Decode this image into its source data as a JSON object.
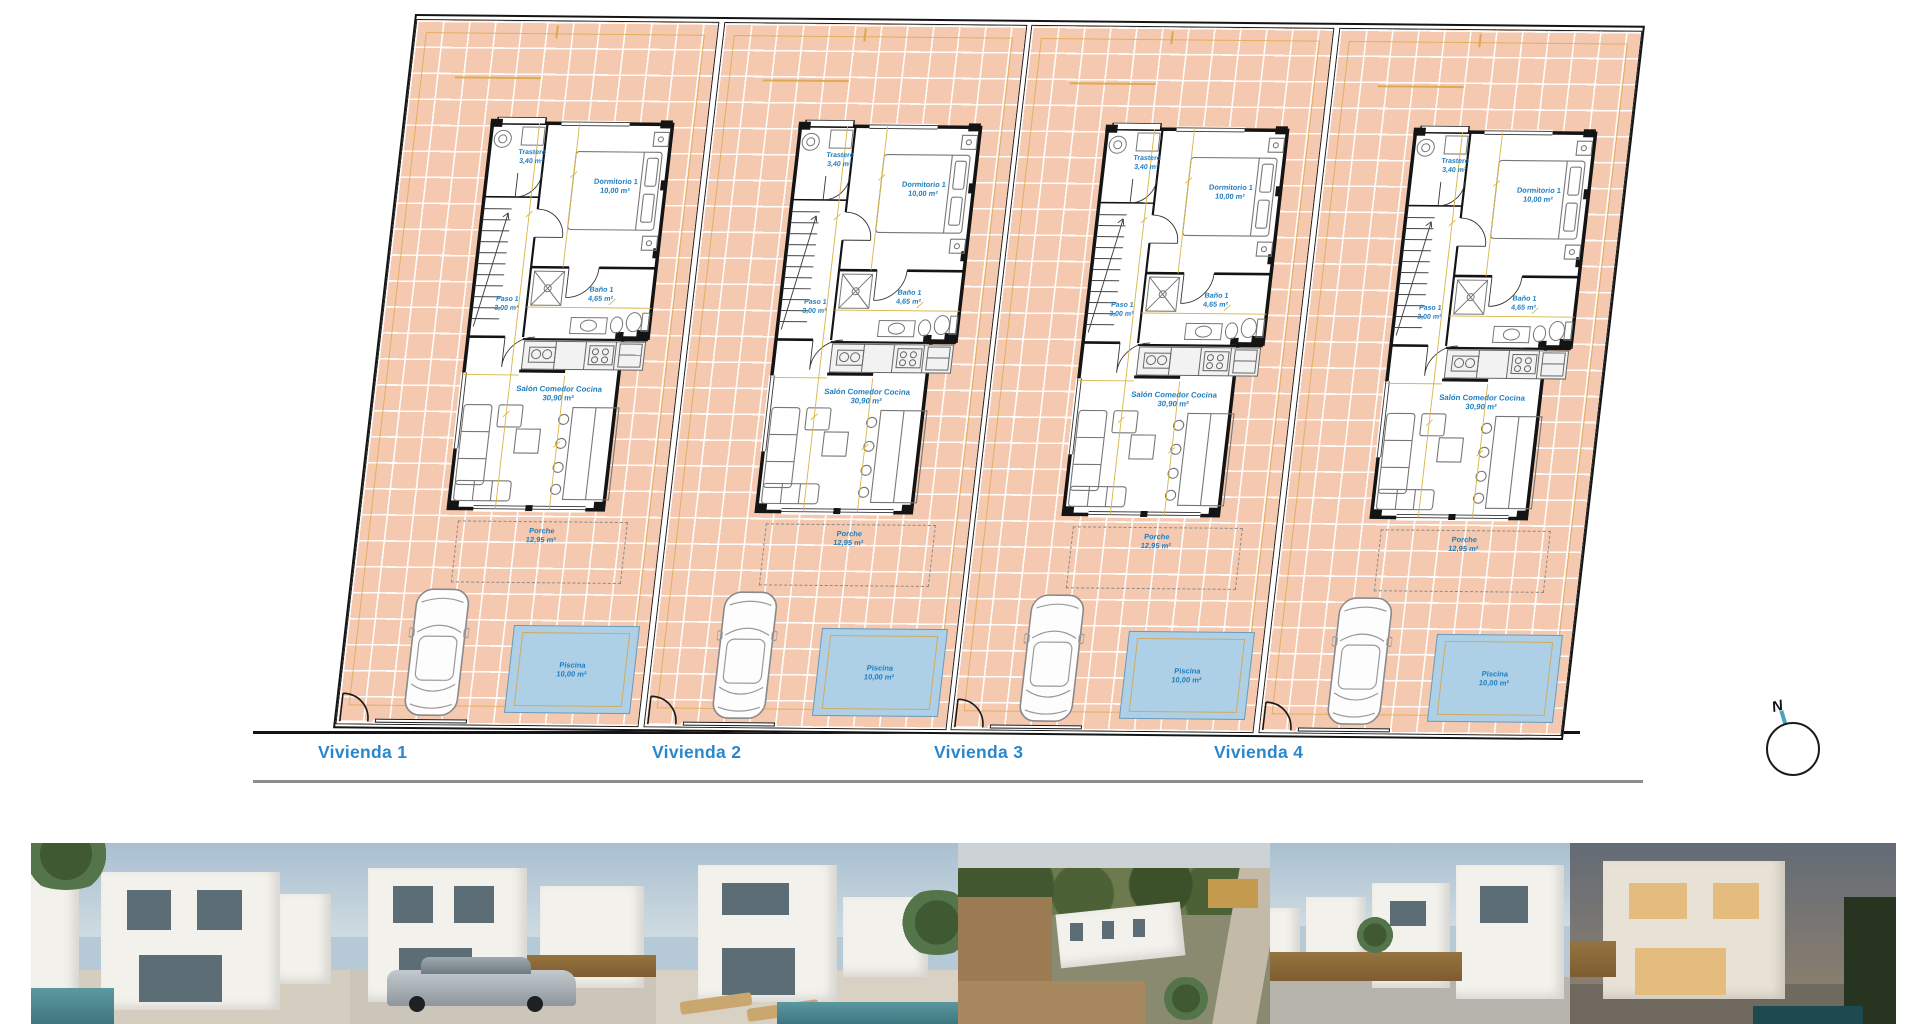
{
  "site": {
    "viviendas": [
      {
        "label": "Vivienda 1"
      },
      {
        "label": "Vivienda 2"
      },
      {
        "label": "Vivienda 3"
      },
      {
        "label": "Vivienda 4"
      }
    ],
    "compass_label": "N"
  },
  "plan": {
    "rooms": {
      "trastero": {
        "name": "Trastero",
        "area": "3,40 m²"
      },
      "dormitorio": {
        "name": "Dormitorio 1",
        "area": "10,00 m²"
      },
      "paso": {
        "name": "Paso 1",
        "area": "3,00 m²"
      },
      "bano": {
        "name": "Baño 1",
        "area": "4,65 m²"
      },
      "salon": {
        "name": "Salón Comedor Cocina",
        "area": "30,90 m²"
      },
      "porche": {
        "name": "Porche",
        "area": "12,95 m²"
      },
      "piscina": {
        "name": "Piscina",
        "area": "10,00 m²"
      }
    }
  },
  "colors": {
    "accent_blue": "#2a87cc",
    "label_blue": "#1e7dc0",
    "tile_salmon": "#f5c9af",
    "pool_blue": "#aed0e6",
    "dimension_yellow": "#d9b544",
    "wall_black": "#141414"
  },
  "photos": [
    {
      "name": "villa-render-front"
    },
    {
      "name": "villa-render-with-car"
    },
    {
      "name": "villa-render-pool-loungers"
    },
    {
      "name": "aerial-construction-site"
    },
    {
      "name": "street-row-of-villas"
    },
    {
      "name": "villa-render-dusk"
    }
  ]
}
